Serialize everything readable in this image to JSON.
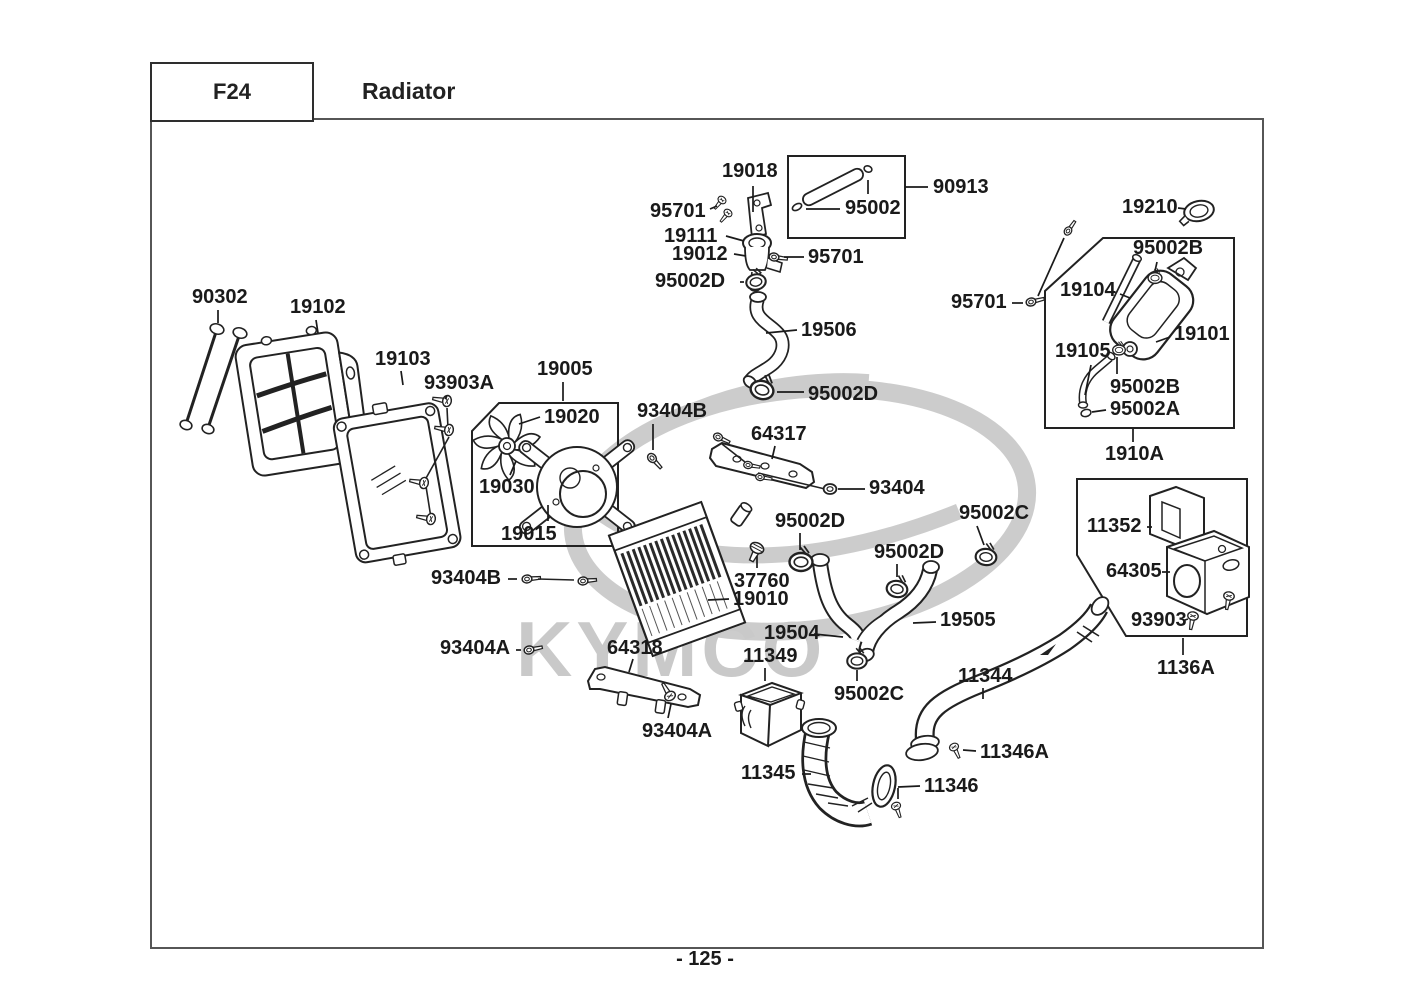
{
  "header": {
    "code": "F24",
    "title": "Radiator"
  },
  "footer": {
    "page_number": "- 125 -"
  },
  "watermark": {
    "text": "KYMCO",
    "color": "#c9c9c9"
  },
  "colors": {
    "frame": "#565656",
    "label": "#1a1a1a",
    "line": "#222222",
    "watermark": "#c9c9c9"
  },
  "labels": [
    {
      "id": "19018",
      "text": "19018",
      "x": 722,
      "y": 161
    },
    {
      "id": "95701-1",
      "text": "95701",
      "x": 650,
      "y": 201
    },
    {
      "id": "19111",
      "text": "19111",
      "x": 664,
      "y": 226
    },
    {
      "id": "19012",
      "text": "19012",
      "x": 672,
      "y": 244
    },
    {
      "id": "95701-2",
      "text": "95701",
      "x": 808,
      "y": 247
    },
    {
      "id": "95002D-1",
      "text": "95002D",
      "x": 655,
      "y": 271
    },
    {
      "id": "95002",
      "text": "95002",
      "x": 845,
      "y": 198
    },
    {
      "id": "90913",
      "text": "90913",
      "x": 933,
      "y": 177
    },
    {
      "id": "19506",
      "text": "19506",
      "x": 801,
      "y": 320
    },
    {
      "id": "95002D-2",
      "text": "95002D",
      "x": 808,
      "y": 384
    },
    {
      "id": "19210",
      "text": "19210",
      "x": 1122,
      "y": 197
    },
    {
      "id": "95002B-1",
      "text": "95002B",
      "x": 1133,
      "y": 238
    },
    {
      "id": "19104",
      "text": "19104",
      "x": 1060,
      "y": 280
    },
    {
      "id": "95701-3",
      "text": "95701",
      "x": 951,
      "y": 292
    },
    {
      "id": "19101",
      "text": "19101",
      "x": 1174,
      "y": 324
    },
    {
      "id": "19105",
      "text": "19105",
      "x": 1055,
      "y": 341
    },
    {
      "id": "95002B-2",
      "text": "95002B",
      "x": 1110,
      "y": 377
    },
    {
      "id": "95002A",
      "text": "95002A",
      "x": 1110,
      "y": 399
    },
    {
      "id": "1910A",
      "text": "1910A",
      "x": 1105,
      "y": 444
    },
    {
      "id": "90302",
      "text": "90302",
      "x": 192,
      "y": 287
    },
    {
      "id": "19102",
      "text": "19102",
      "x": 290,
      "y": 297
    },
    {
      "id": "19103",
      "text": "19103",
      "x": 375,
      "y": 349
    },
    {
      "id": "93903A",
      "text": "93903A",
      "x": 424,
      "y": 373
    },
    {
      "id": "19005",
      "text": "19005",
      "x": 537,
      "y": 359
    },
    {
      "id": "19020",
      "text": "19020",
      "x": 544,
      "y": 407
    },
    {
      "id": "19030",
      "text": "19030",
      "x": 479,
      "y": 477
    },
    {
      "id": "19015",
      "text": "19015",
      "x": 501,
      "y": 524
    },
    {
      "id": "93404B-1",
      "text": "93404B",
      "x": 637,
      "y": 401
    },
    {
      "id": "64317",
      "text": "64317",
      "x": 751,
      "y": 424
    },
    {
      "id": "93404",
      "text": "93404",
      "x": 869,
      "y": 478
    },
    {
      "id": "95002D-3",
      "text": "95002D",
      "x": 775,
      "y": 511
    },
    {
      "id": "95002C-1",
      "text": "95002C",
      "x": 959,
      "y": 503
    },
    {
      "id": "95002D-4",
      "text": "95002D",
      "x": 874,
      "y": 542
    },
    {
      "id": "37760",
      "text": "37760",
      "x": 734,
      "y": 571
    },
    {
      "id": "19010",
      "text": "19010",
      "x": 733,
      "y": 589
    },
    {
      "id": "19504",
      "text": "19504",
      "x": 764,
      "y": 623
    },
    {
      "id": "19505",
      "text": "19505",
      "x": 940,
      "y": 610
    },
    {
      "id": "11349",
      "text": "11349",
      "x": 743,
      "y": 646
    },
    {
      "id": "64318",
      "text": "64318",
      "x": 607,
      "y": 638
    },
    {
      "id": "93404B-2",
      "text": "93404B",
      "x": 431,
      "y": 568
    },
    {
      "id": "93404A-1",
      "text": "93404A",
      "x": 440,
      "y": 638
    },
    {
      "id": "93404A-2",
      "text": "93404A",
      "x": 642,
      "y": 721
    },
    {
      "id": "95002C-2",
      "text": "95002C",
      "x": 834,
      "y": 684
    },
    {
      "id": "11344",
      "text": "11344",
      "x": 958,
      "y": 666
    },
    {
      "id": "11346A",
      "text": "11346A",
      "x": 980,
      "y": 742
    },
    {
      "id": "11345",
      "text": "11345",
      "x": 741,
      "y": 763
    },
    {
      "id": "11346",
      "text": "11346",
      "x": 924,
      "y": 776
    },
    {
      "id": "11352",
      "text": "11352",
      "x": 1087,
      "y": 516
    },
    {
      "id": "64305",
      "text": "64305",
      "x": 1106,
      "y": 561
    },
    {
      "id": "93903",
      "text": "93903",
      "x": 1131,
      "y": 610
    },
    {
      "id": "1136A",
      "text": "1136A",
      "x": 1157,
      "y": 658
    }
  ]
}
